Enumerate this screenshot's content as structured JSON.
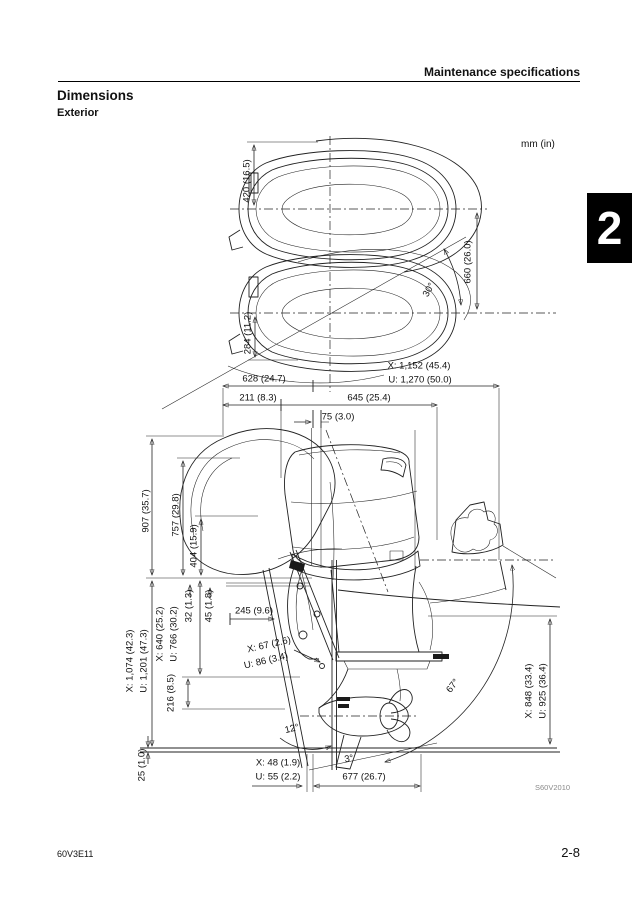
{
  "page": {
    "header": "Maintenance specifications",
    "section_title": "Dimensions",
    "subsection_title": "Exterior",
    "units": "mm (in)",
    "chapter_number": "2",
    "figure_id": "S60V2010",
    "doc_code": "60V3E11",
    "page_number": "2-8"
  },
  "dims": {
    "d420": "420 (16.5)",
    "d660": "660 (26.0)",
    "d284": "284 (11.2)",
    "a30": "30°",
    "x1152": "X: 1,152 (45.4)",
    "u1270": "U: 1,270 (50.0)",
    "d628": "628 (24.7)",
    "d211": "211 (8.3)",
    "d645": "645 (25.4)",
    "d75": "75 (3.0)",
    "d907": "907 (35.7)",
    "d757": "757 (29.8)",
    "d404": "404 (15.9)",
    "d32": "32 (1.3)",
    "d45": "45 (1.8)",
    "d245": "245 (9.6)",
    "x640": "X: 640 (25.2)",
    "u766": "U: 766 (30.2)",
    "x1074": "X: 1,074 (42.3)",
    "u1201": "U: 1,201 (47.3)",
    "d216": "216 (8.5)",
    "x67": "X: 67 (2.6)",
    "u86": "U: 86 (3.4)",
    "a12": "12°",
    "a3": "3°",
    "d25": "25 (1.0)",
    "x48": "X: 48 (1.9)",
    "u55": "U: 55 (2.2)",
    "d677": "677 (26.7)",
    "a67": "67°",
    "x848": "X: 848 (33.4)",
    "u925": "U: 925 (36.4)"
  }
}
